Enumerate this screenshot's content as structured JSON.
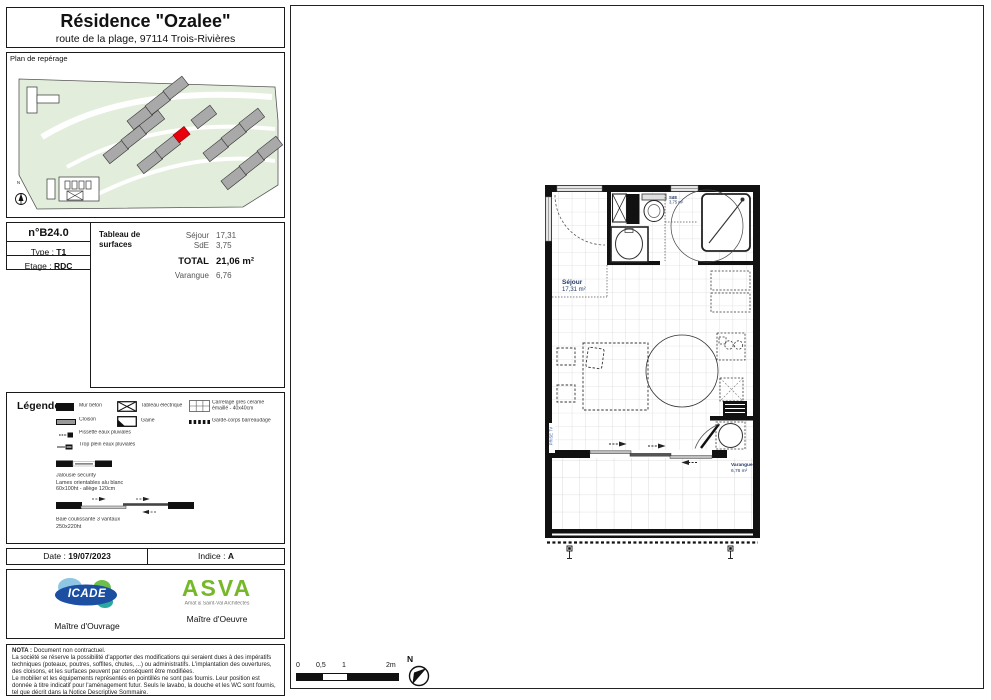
{
  "header": {
    "title": "Résidence \"Ozalee\"",
    "subtitle": "route de la plage, 97114 Trois-Rivières"
  },
  "site_plan": {
    "label": "Plan de repérage",
    "north": "N"
  },
  "unit": {
    "number": "n°B24.0",
    "type_label": "Type : ",
    "type_value": "T1",
    "floor_label": "Etage : ",
    "floor_value": "RDC"
  },
  "surfaces": {
    "heading_line1": "Tableau de",
    "heading_line2": "surfaces",
    "rows": [
      {
        "label": "Séjour",
        "value": "17,31"
      },
      {
        "label": "SdE",
        "value": "3,75"
      }
    ],
    "total_label": "TOTAL",
    "total_value": "21,06 m²",
    "extra_label": "Varangue",
    "extra_value": "6,76"
  },
  "legend": {
    "heading": "Légende :",
    "wall": "Mur béton",
    "partition": "Cloison",
    "panel": "Tableau électrique",
    "duct": "Gaine",
    "tile_line1": "Carrelage grès cérame",
    "tile_line2": "émaillé - 40x40cm",
    "railing": "Garde-corps barreaudage",
    "spout": "Pissette eaux pluviales",
    "overflow": "Trop plein eaux pluviales",
    "jalousie_line1": "Jalousie security",
    "jalousie_line2": "Lames orientables alu blanc",
    "jalousie_line3": "60x100ht - allège 120cm",
    "bay_line1": "Baie coulissante 3 vantaux",
    "bay_line2": "250x220ht"
  },
  "footer": {
    "date_label": "Date : ",
    "date_value": "19/07/2023",
    "index_label": "Indice : ",
    "index_value": "A"
  },
  "stakeholders": {
    "owner_logo": "ICADE",
    "owner_caption": "Maître d'Ouvrage",
    "architect_logo": "ASVA",
    "architect_sub": "Amat & Saint-Val Architectes",
    "architect_caption": "Maître d'Oeuvre"
  },
  "nota": {
    "label": "NOTA : ",
    "intro": "Document non contractuel.",
    "para1": "La société se réserve la possibilité d'apporter des modifications qui seraient dues à des impératifs techniques (poteaux, poutres, soffites, chutes, ...) ou administratifs. L'implantation des ouvertures, des cloisons, et les surfaces peuvent par conséquent être modifiées.",
    "para2": "Le mobilier et les équipements représentés en pointillés ne sont pas fournis. Leur position est donnée à titre indicatif pour l'aménagement futur. Seuls le lavabo, la douche et les WC sont fournis, tel que décrit dans la Notice Descriptive Sommaire."
  },
  "plan": {
    "sejour_label": "Séjour",
    "sejour_area": "17,31 m²",
    "sde_label": "SdE",
    "sde_area": "3,75 m²",
    "varangue_label": "Varangue",
    "varangue_area": "6,76 m²",
    "tv_label": "PRISE TV"
  },
  "scale": {
    "t0": "0",
    "t05": "0,5",
    "t1": "1",
    "t2": "2m",
    "north": "N"
  },
  "colors": {
    "site_green": "#e2eedb",
    "building_gray": "#a9a9a9",
    "unit_red": "#e8000d",
    "icade_blue": "#1c4fa1",
    "asva_green": "#76b82a"
  }
}
